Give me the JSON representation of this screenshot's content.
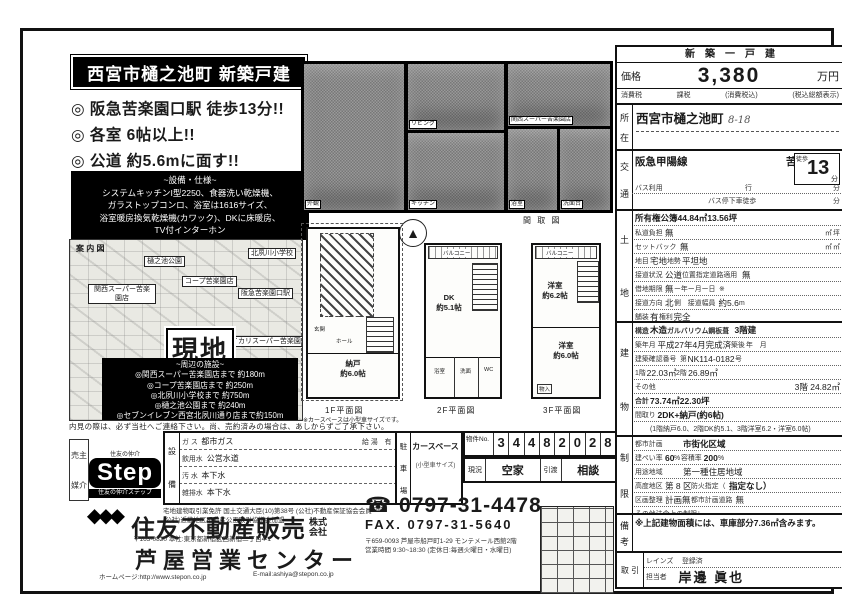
{
  "title_box": "西宮市樋之池町 新築戸建",
  "bullets": {
    "b0": "◎ 阪急苦楽園口駅 徒歩13分!!",
    "b1": "◎ 各室 6帖以上!!",
    "b2": "◎ 公道 約5.6mに面す!!"
  },
  "spec": {
    "heading": "~設備・仕様~",
    "l0": "システムキッチンI型2250、食器洗い乾燥機、",
    "l1": "ガラストップコンロ、浴室は1616サイズ、",
    "l2": "浴室暖房換気乾燥機(カワック)、DKに床暖房、",
    "l3": "TV付インターホン"
  },
  "photos": {
    "outside": "外観",
    "living": "リビング",
    "kitchen": "キッチン",
    "area": "関西スーパー苦楽園店",
    "bath": "浴室",
    "wash": "洗面台"
  },
  "map": {
    "corner": "案 内 図",
    "park": "樋之池公園",
    "school": "北夙川小学校",
    "coop": "コープ苦楽園店",
    "kansai": "関西スーパー苦楽園店",
    "station": "阪急苦楽園口駅",
    "ikari": "イカリスーパー苦楽園店",
    "genchi": "現地",
    "fac_heading": "~周辺の施設~",
    "fac0": "◎関西スーパー苦楽園店まで 約180m",
    "fac1": "◎コープ苦楽園店まで 約250m",
    "fac2": "◎北夙川小学校まで 約750m",
    "fac3": "◎樋之池公園まで 約240m",
    "fac4": "◎セブンイレブン西宮北夙川通り店まで約150m",
    "note": "内見の際は、必ず当社へご連絡下さい。尚、売約済みの場合は、あしからずご了承下さい。"
  },
  "plans": {
    "scale_note": "間 取 図",
    "compass": "▲",
    "f1": {
      "car": "カースペース",
      "genkan": "玄関",
      "hall": "ホール",
      "room": "納戸",
      "size": "約6.0帖",
      "caption": "1F平面図",
      "note": "※カースペースは小型車サイズです。"
    },
    "f2": {
      "balcony": "バルコニー",
      "dk": "DK",
      "size": "約5.1帖",
      "bath": "浴室",
      "wash": "洗面",
      "wc": "WC",
      "caption": "2F平面図"
    },
    "f3": {
      "balcony": "バルコニー",
      "room1": "洋室",
      "size1": "約6.2帖",
      "room2": "洋室",
      "size2": "約6.0帖",
      "closet": "物入",
      "caption": "3F平面図"
    }
  },
  "price_box": {
    "header": "新　築　一　戸　建",
    "price_label": "価格",
    "price": "3,380",
    "unit": "万円",
    "tax_l": "消費税",
    "tax_v": "課税",
    "tax_n": "(消費税込)",
    "tax_r": "(税込総額表示)"
  },
  "location": {
    "label_1": "所",
    "label_2": "在",
    "value": "西宮市樋之池町",
    "hand": "8-18"
  },
  "access": {
    "label_1": "交",
    "label_2": "通",
    "line": "阪急甲陽線",
    "station": "苦楽園口",
    "eki": "駅",
    "walk": "徒歩",
    "min": "13",
    "fun": "分",
    "bus1": "バス利用",
    "bus1r": "行",
    "bus1u": "分",
    "bus2": "バス停下車徒歩",
    "bus2u": "分"
  },
  "land": {
    "label_1": "土",
    "label_2": "地",
    "r0l": "所有権",
    "r0v": "公簿",
    "r0a": "44.84㎡",
    "r0b": "13.56坪",
    "r1l": "私道負担",
    "r1v": "無",
    "r1a": "㎡",
    "r1b": "坪",
    "r2l": "セットバック",
    "r2v": "無",
    "r2a": "㎡",
    "r2b": "㎡",
    "r3l": "地目",
    "r3v": "宅地",
    "r3m": "地勢",
    "r3r": "平坦地",
    "r4l": "接道状況",
    "r4v": "公道",
    "r4m": "位置指定道路適用",
    "r4r": "無",
    "r5l": "借地期限",
    "r5v": "無",
    "r5m": "ー年ー月ー日",
    "r5r": "※",
    "r6l": "接道方向",
    "r6v": "北",
    "r6m": "側　接道幅員",
    "r6r": "約5.6",
    "r6u": "m",
    "r7l": "舗装",
    "r7v": "有",
    "r7m": "権利",
    "r7r": "完全"
  },
  "building": {
    "label_1": "建",
    "label_2": "物",
    "r0l": "構造",
    "r0v": "木造",
    "r0m": "ガルバリウム鋼板葺",
    "r0r": "3階建",
    "r1l": "築年月",
    "r1v": "平成27年4月完成済",
    "r1m": "築後",
    "r1r": "年　月",
    "r2l": "建築確認番号",
    "r2v": "第",
    "r2m": "NK114-0182",
    "r2r": "号",
    "r3l": "1階",
    "r3v": "22.03㎡",
    "r3m": "2階",
    "r3r": "26.89㎡",
    "r4l": "その他",
    "r4v": "3階 24.82㎡",
    "r5l": "合計",
    "r5v": "73.74㎡",
    "r5r": "22.30坪",
    "r6l": "間取り",
    "r6v": "2DK+納戸(約6帖)",
    "r7": "(1階納戸6.0、2階DK約5.1、3階洋室6.2・洋室6.0帖)"
  },
  "law": {
    "label_1": "制",
    "label_2": "限",
    "r0l": "都市計画",
    "r0v": "市街化区域",
    "r1l": "建ぺい率",
    "r1v": "60",
    "r1u": "%",
    "r1m": "容積率",
    "r1r": "200",
    "r1ru": "%",
    "r2l": "用途地域",
    "r2v": "第一種住居地域",
    "r3l": "高度地区",
    "r3v": "第 8 区",
    "r3m": "防火指定（",
    "r3r": "指定なし）",
    "r4l": "区画整理",
    "r4v": "計画無",
    "r4m": "都市計画道路",
    "r4r": "無",
    "r5": "その他法令上の制限："
  },
  "remarks": {
    "label_1": "備",
    "label_2": "考",
    "text": "※上記建物面積には、車庫部分7.36㎡含みます。"
  },
  "agent": {
    "label": "取 引",
    "reins": "レインズ",
    "touroku": "登録済",
    "tantou_label": "担当者",
    "tantou": "岸邊 眞也"
  },
  "footer": {
    "dealer1": "売主",
    "dealer2": "媒介",
    "sumitomo_tiny": "住友の仲介",
    "step": "Step",
    "step_band": "住友の仲介ステップ",
    "equip_1": "設",
    "equip_2": "備",
    "e0l": "ガ ス",
    "e0v": "都市ガス",
    "e0m": "給 湯　有",
    "e1l": "飲用水",
    "e1v": "公営水道",
    "e2l": "汚 水",
    "e2v": "本下水",
    "e3l": "雑排水",
    "e3v": "本下水",
    "park_1": "駐",
    "park_2": "車",
    "park_3": "場",
    "park_v": "カースペース",
    "park_note": "(小型車サイズ)",
    "no_label": "物件No.",
    "digits": [
      "3",
      "4",
      "4",
      "8",
      "2",
      "0",
      "2",
      "8"
    ],
    "genkyo_l": "現況",
    "genkyo_v": "空家",
    "hikiwatashi_l": "引渡",
    "hikiwatashi_v": "相談",
    "license1": "宅地建物取引業免許 国土交通大臣(10)第38号 (公社)不動産保証協会会員",
    "license2": "(公社)近畿地区不動産公正取引協議会加盟",
    "tel_icon": "☎",
    "tel": "0797-31-4478",
    "fax": "FAX.  0797-31-5640",
    "diamond_glyphs": "◆◆◆",
    "company": "住友不動産販売",
    "kabushiki1": "株式",
    "kabushiki2": "会社",
    "hq": "〒163-0820 本社:東京都新宿区西新宿二丁目4-1",
    "office": "芦屋営業センター",
    "addr": "〒659-0093 芦屋市船戸町1-29 モンテメール西館2階",
    "hours": "営業時間 9:30~18:30 (定休日:毎週火曜日・水曜日)",
    "web": "ホームページ:http://www.stepon.co.jp",
    "email": "E-mail:ashiya@stepon.co.jp"
  }
}
